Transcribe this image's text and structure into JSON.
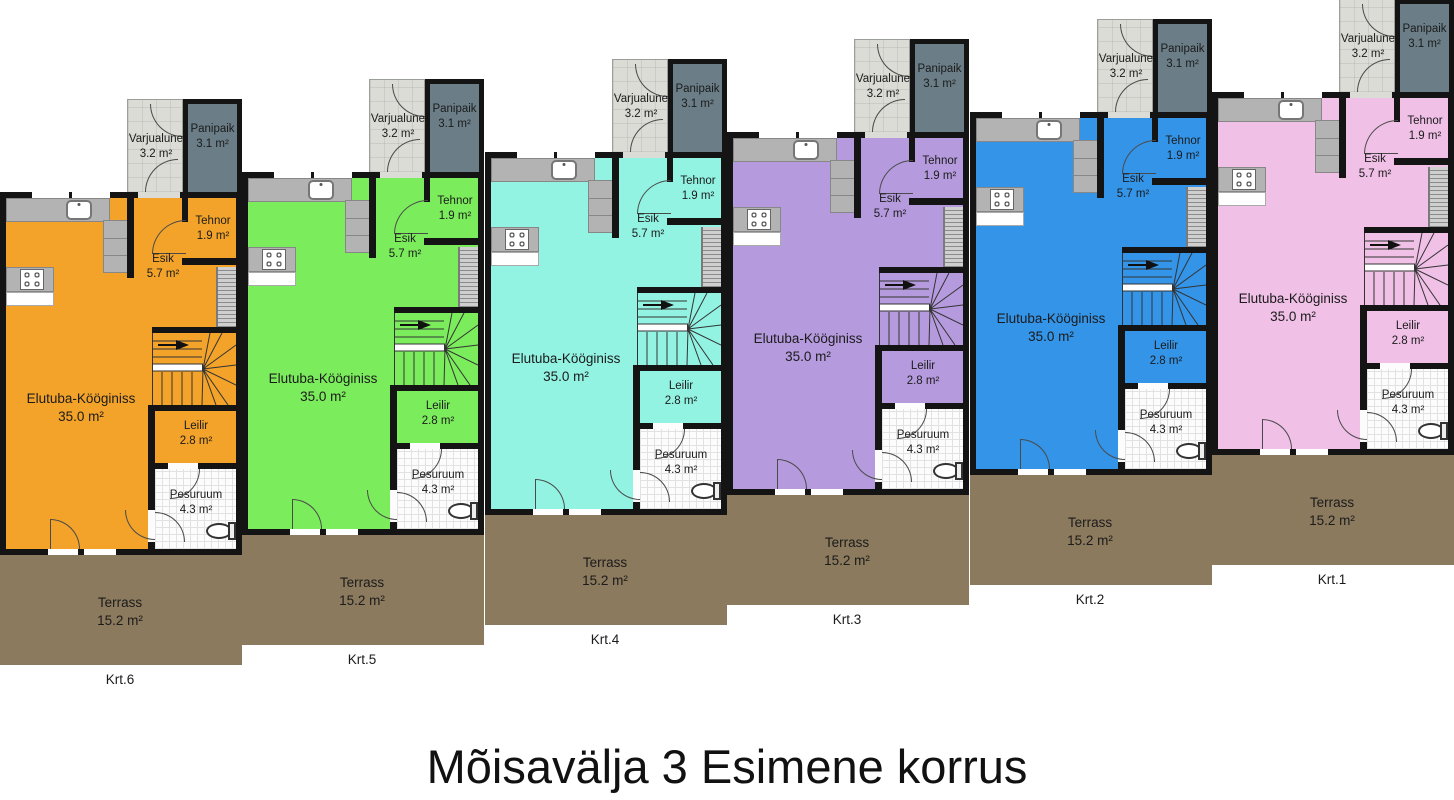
{
  "title": "Mõisavälja 3 Esimene korrus",
  "rooms": {
    "elutuba": {
      "name": "Elutuba-Kööginiss",
      "area": "35.0 m²"
    },
    "leilir": {
      "name": "Leilir",
      "area": "2.8 m²"
    },
    "pesuruum": {
      "name": "Pesuruum",
      "area": "4.3 m²"
    },
    "esik": {
      "name": "Esik",
      "area": "5.7 m²"
    },
    "tehnor": {
      "name": "Tehnor",
      "area": "1.9 m²"
    },
    "varjualune": {
      "name": "Varjualune",
      "area": "3.2 m²"
    },
    "panipaik": {
      "name": "Panipaik",
      "area": "3.1 m²"
    },
    "terrass": {
      "name": "Terrass",
      "area": "15.2 m²"
    }
  },
  "units": [
    {
      "id": "Krt.6",
      "color": "#F3A329",
      "x": 0,
      "y": 192
    },
    {
      "id": "Krt.5",
      "color": "#7BEC5C",
      "x": 242,
      "y": 172
    },
    {
      "id": "Krt.4",
      "color": "#93F3E3",
      "x": 485,
      "y": 152
    },
    {
      "id": "Krt.3",
      "color": "#B59BDD",
      "x": 727,
      "y": 132
    },
    {
      "id": "Krt.2",
      "color": "#3394E8",
      "x": 970,
      "y": 112
    },
    {
      "id": "Krt.1",
      "color": "#F0C0E7",
      "x": 1212,
      "y": 92
    }
  ],
  "palette": {
    "walls": "#141414",
    "terrace": "#8B7A5D",
    "panipaik": "#6B7E87",
    "varju": "#DADCD5",
    "counter": "#B3B3B3"
  }
}
